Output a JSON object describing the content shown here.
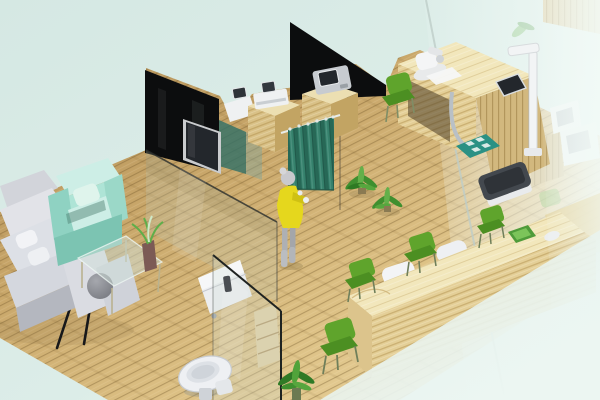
{
  "meta": {
    "kind": "3d-isometric-interior-render",
    "subject": "Clinic / office interior floor-plan visualization",
    "width_px": 600,
    "height_px": 400
  },
  "palette": {
    "background_top": "#d5e8e3",
    "background_bottom": "#edf6f2",
    "floor_dark": "#ab8952",
    "floor_mid": "#cfae72",
    "floor_light": "#ecd9a4",
    "plank_line": "#694e23",
    "panel_black": "#0c0d0e",
    "glass_edge": "#1f2321",
    "glass_tint": "#b9cfc6",
    "curtain_teal": "#35816c",
    "curtain_fold": "#27685a",
    "wood_cabinet_top": "#ecdfb2",
    "wood_cabinet_front": "#d9c187",
    "wood_cabinet_side": "#c2a463",
    "wood_desk_top": "#f2e7bc",
    "wood_desk_front": "#e4cf97",
    "device_white": "#eff1f2",
    "device_gray": "#c7cbd0",
    "screen_dark": "#23272c",
    "chair_green": "#5fa42c",
    "chair_green_dark": "#4c8f22",
    "armchair_mint": "#aee4d6",
    "armchair_mint_light": "#cdeee6",
    "armchair_mint_shadow": "#7cc4b2",
    "sofa_light": "#e2e3e8",
    "sofa_mid": "#cfd2d9",
    "sofa_shadow": "#b4b7bf",
    "dress_yellow": "#e5d71d",
    "mannequin_gray": "#c9c9cd",
    "plant_green": "#3f8f2f",
    "plant_green_light": "#63b04a",
    "mat_teal": "#2b9184",
    "scale_dark": "#43484e",
    "toilet_white": "#eef0f3",
    "chrome": "#b9c0c6",
    "haze_white": "#f2faf7"
  },
  "scene": {
    "areas": [
      "lounge",
      "exam-room",
      "consultation-room",
      "bathroom",
      "reception",
      "lab-behind-glass"
    ],
    "objects": [
      {
        "name": "wood-floor",
        "desc": "diagonal plank wood floor"
      },
      {
        "name": "tv-wall-panel",
        "desc": "black glass partition with wall TV"
      },
      {
        "name": "wall-tv",
        "desc": "flat screen mounted on dark panel"
      },
      {
        "name": "glass-partition",
        "desc": "low glass wall between lounge and exam room"
      },
      {
        "name": "dark-panel-2",
        "desc": "second black partition behind cabinets"
      },
      {
        "name": "equipment-cabinet-1",
        "desc": "wood cabinet with white diagnostic device"
      },
      {
        "name": "equipment-cabinet-2",
        "desc": "wood cabinet with gray monitor device"
      },
      {
        "name": "privacy-curtain",
        "desc": "teal hanging curtain on rail"
      },
      {
        "name": "patient-figure",
        "desc": "mannequin woman in yellow dress at curtain"
      },
      {
        "name": "floor-plants",
        "desc": "two potted green plants"
      },
      {
        "name": "exam-desk",
        "desc": "L-shaped blond wood exam counter with tablet"
      },
      {
        "name": "height-rod",
        "desc": "white height measuring stand"
      },
      {
        "name": "weighing-scale",
        "desc": "dark floor scale on white plinth"
      },
      {
        "name": "floor-mat",
        "desc": "teal mat with white squares"
      },
      {
        "name": "sofa",
        "desc": "white L-shaped sectional sofa with pillows and gray ball cushion"
      },
      {
        "name": "accent-armchair",
        "desc": "mint green armchair"
      },
      {
        "name": "display-easel",
        "desc": "dark screen on tripod easel"
      },
      {
        "name": "coffee-table",
        "desc": "glass coffee table with plant in vase"
      },
      {
        "name": "side-cabinet",
        "desc": "white rolling side cabinet"
      },
      {
        "name": "bathroom-glass-door",
        "desc": "framed glass panel with handle"
      },
      {
        "name": "toilet",
        "desc": "white toilet seen from above"
      },
      {
        "name": "bathroom-shelf",
        "desc": "small wood shelf behind glass"
      },
      {
        "name": "reception-desk",
        "desc": "long laminated blond wood counter"
      },
      {
        "name": "reception-counter-units",
        "desc": "two white seat-shaped units on counter"
      },
      {
        "name": "desk-tray",
        "desc": "green tray and white mouse on counter"
      },
      {
        "name": "waiting-chairs",
        "desc": "four green waiting chairs"
      },
      {
        "name": "glass-wall-right",
        "desc": "hazy glass wall with lab equipment behind"
      }
    ]
  }
}
